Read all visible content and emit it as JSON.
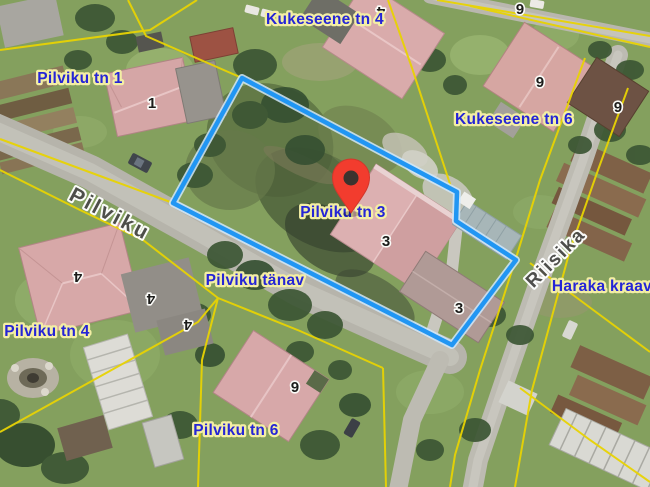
{
  "map": {
    "address_labels": [
      {
        "text": "Kukeseene tn 4"
      },
      {
        "text": "Pilviku tn 1"
      },
      {
        "text": "Kukeseene tn 6"
      },
      {
        "text": "Pilviku tn 3"
      },
      {
        "text": "Pilviku tänav"
      },
      {
        "text": "Pilviku tn 4"
      },
      {
        "text": "Pilviku tn 6"
      },
      {
        "text": "Haraka kraav"
      }
    ],
    "street_names": [
      {
        "text": "Pilviku"
      },
      {
        "text": "Riisika"
      }
    ],
    "building_numbers": [
      {
        "text": "1"
      },
      {
        "text": "4"
      },
      {
        "text": "6"
      },
      {
        "text": "6"
      },
      {
        "text": "6"
      },
      {
        "text": "3"
      },
      {
        "text": "3"
      },
      {
        "text": "4"
      },
      {
        "text": "4"
      },
      {
        "text": "4"
      },
      {
        "text": "6"
      }
    ],
    "colors": {
      "parcel_highlight": "#2196f3",
      "parcel_highlight_halo": "#cfe7fb",
      "cadastral_line": "#e8d303",
      "address_label_text": "#2525d6",
      "address_label_halo": "#f3eea4",
      "street_label_text": "#4b4b49",
      "marker": "#f23c2e"
    }
  }
}
